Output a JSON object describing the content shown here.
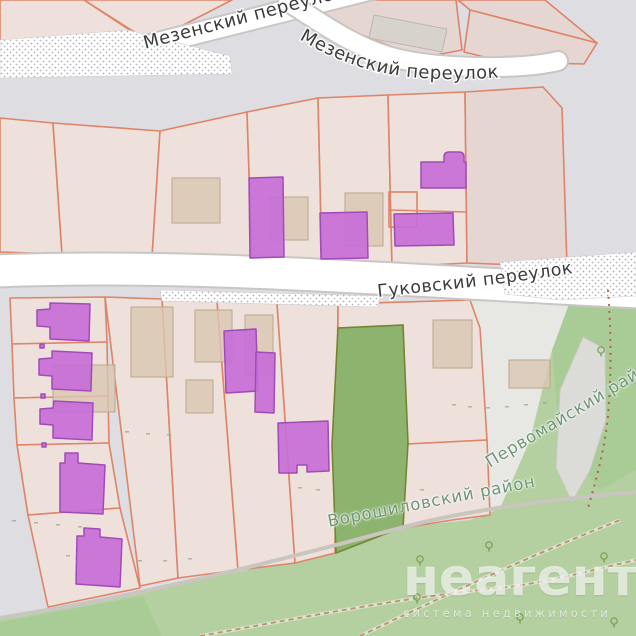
{
  "map": {
    "street_labels": {
      "mezensky_upper": "Мезенский переулок",
      "mezensky_lane": "Мезенский переулок",
      "gukovsky_lane": "Гуковский переулок"
    },
    "district_labels": {
      "pervomaysky": "Первомайский район",
      "voroshilovsky": "Ворошиловский район"
    },
    "colors": {
      "background": "#dedde2",
      "parcel_fill": "#eee0da",
      "parcel_border": "#de8468",
      "residential_building_fill": "#c76ed8",
      "residential_building_border": "#a14bb8",
      "generic_building_fill": "#d9c7b3",
      "generic_building_border": "#bda78a",
      "gray_building_fill": "#d6d1cc",
      "grass_parcel_fill": "#8db46f",
      "grass_parcel_border": "#76842f",
      "park_fill": "#b4d0a0",
      "road_fill": "#ffffff",
      "road_casing": "#c9c6c3",
      "road_label_color": "#3c3c3c",
      "district_label_color": "#6f9475",
      "admin_boundary_color": "#b25a48",
      "footpath_color": "#bb8066",
      "watermark_color": "#ffffff"
    },
    "icons": [
      "tree-icon"
    ]
  },
  "watermark": {
    "brand": "неагент",
    "tagline": "система недвижимости"
  }
}
